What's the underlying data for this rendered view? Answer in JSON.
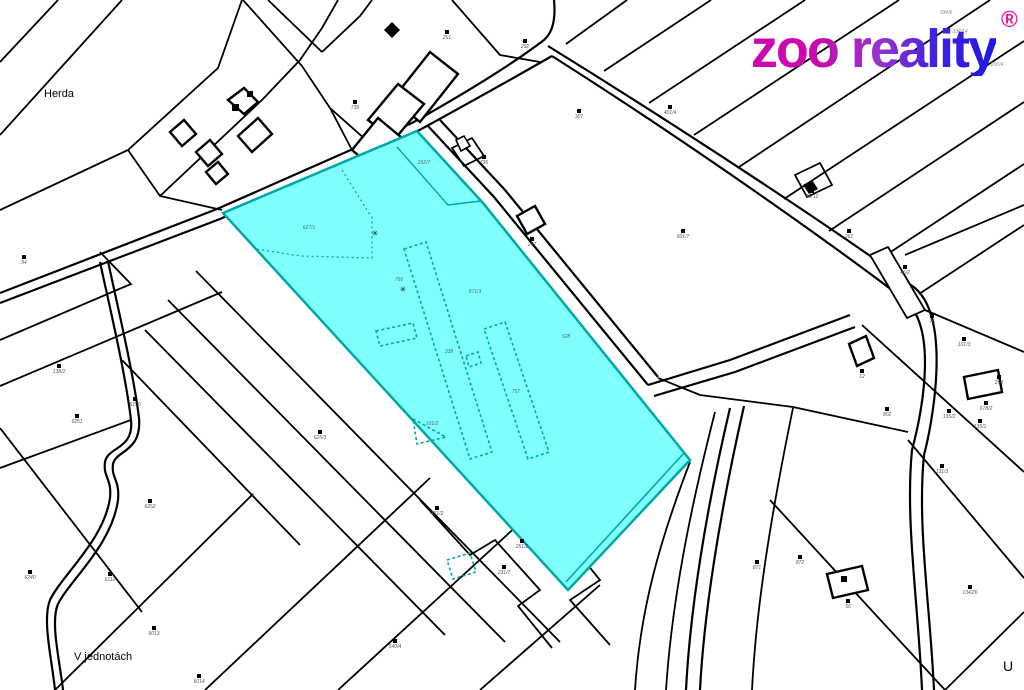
{
  "map": {
    "type": "cadastral-map",
    "background_color": "#ffffff",
    "line_color": "#000000",
    "highlight": {
      "fill": "#80ffff",
      "stroke": "#00a8a8"
    },
    "labels": {
      "village": "Herda",
      "field": "V jednotách",
      "corner": "U"
    },
    "markers": [
      {
        "x": 28,
        "y": 570,
        "t": "6240"
      },
      {
        "x": 108,
        "y": 572,
        "t": "6112"
      },
      {
        "x": 152,
        "y": 626,
        "t": "6013"
      },
      {
        "x": 197,
        "y": 674,
        "t": "6014"
      },
      {
        "x": 75,
        "y": 414,
        "t": "6251"
      },
      {
        "x": 133,
        "y": 397,
        "t": "6150"
      },
      {
        "x": 148,
        "y": 499,
        "t": "6252"
      },
      {
        "x": 22,
        "y": 255,
        "t": "94"
      },
      {
        "x": 57,
        "y": 364,
        "t": "138/2"
      },
      {
        "x": 318,
        "y": 430,
        "t": "625/3"
      },
      {
        "x": 393,
        "y": 639,
        "t": "540/4"
      },
      {
        "x": 435,
        "y": 506,
        "t": "451/2"
      },
      {
        "x": 520,
        "y": 539,
        "t": "251/2"
      },
      {
        "x": 502,
        "y": 565,
        "t": "231/7"
      },
      {
        "x": 353,
        "y": 100,
        "t": "739"
      },
      {
        "x": 445,
        "y": 30,
        "t": "291"
      },
      {
        "x": 523,
        "y": 39,
        "t": "292"
      },
      {
        "x": 577,
        "y": 109,
        "t": "307"
      },
      {
        "x": 668,
        "y": 105,
        "t": "401/4"
      },
      {
        "x": 681,
        "y": 229,
        "t": "601/7"
      },
      {
        "x": 810,
        "y": 189,
        "t": "46/12"
      },
      {
        "x": 847,
        "y": 229,
        "t": "261"
      },
      {
        "x": 903,
        "y": 265,
        "t": "46/2"
      },
      {
        "x": 930,
        "y": 314,
        "t": "76"
      },
      {
        "x": 962,
        "y": 337,
        "t": "101/3"
      },
      {
        "x": 997,
        "y": 375,
        "t": "204"
      },
      {
        "x": 860,
        "y": 369,
        "t": "12"
      },
      {
        "x": 984,
        "y": 401,
        "t": "678/2"
      },
      {
        "x": 885,
        "y": 407,
        "t": "802"
      },
      {
        "x": 947,
        "y": 409,
        "t": "135/2"
      },
      {
        "x": 978,
        "y": 419,
        "t": "135/1"
      },
      {
        "x": 940,
        "y": 464,
        "t": "131/3"
      },
      {
        "x": 968,
        "y": 585,
        "t": "1342/6"
      },
      {
        "x": 755,
        "y": 560,
        "t": "871"
      },
      {
        "x": 798,
        "y": 555,
        "t": "872"
      },
      {
        "x": 846,
        "y": 599,
        "t": "56"
      },
      {
        "x": 482,
        "y": 155,
        "t": "736"
      },
      {
        "x": 530,
        "y": 237,
        "t": "257"
      }
    ],
    "parcel_labels": [
      {
        "x": 946,
        "y": 10,
        "t": "334/6"
      },
      {
        "x": 960,
        "y": 29,
        "t": "334/14"
      },
      {
        "x": 997,
        "y": 62,
        "t": "200/4"
      }
    ],
    "highlight_labels": [
      {
        "x": 309,
        "y": 225,
        "t": "627/1"
      },
      {
        "x": 424,
        "y": 160,
        "t": "292/7"
      },
      {
        "x": 475,
        "y": 289,
        "t": "871/3"
      },
      {
        "x": 399,
        "y": 277,
        "t": "756"
      },
      {
        "x": 449,
        "y": 349,
        "t": "338"
      },
      {
        "x": 516,
        "y": 389,
        "t": "757"
      },
      {
        "x": 566,
        "y": 334,
        "t": "628"
      },
      {
        "x": 432,
        "y": 421,
        "t": "101/2"
      }
    ],
    "symbols": [
      {
        "x": 375,
        "y": 234
      },
      {
        "x": 403,
        "y": 290
      }
    ]
  },
  "logo": {
    "part1": "zoo",
    "part2": "reality",
    "registered": "®",
    "color_start": "#cb07ad",
    "color_end": "#1b17e6",
    "registered_color": "#f0169b"
  }
}
